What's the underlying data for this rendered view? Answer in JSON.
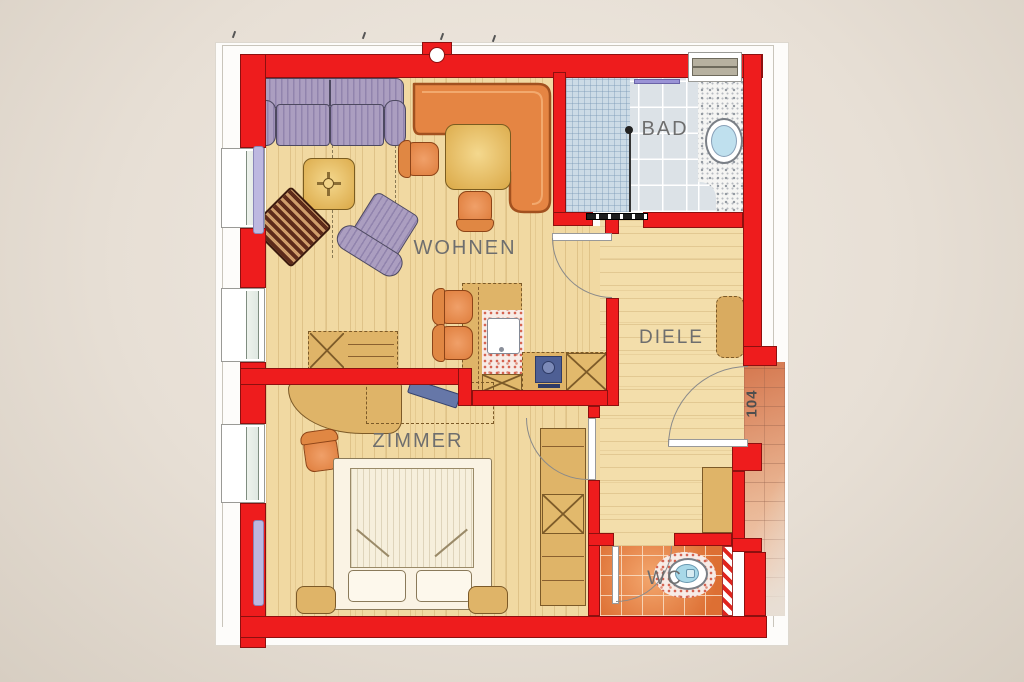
{
  "rooms": {
    "living": {
      "label": "WOHNEN"
    },
    "bedroom": {
      "label": "ZIMMER"
    },
    "hallway": {
      "label": "DIELE"
    },
    "bathroom": {
      "label": "BAD"
    },
    "toilet": {
      "label": "WC"
    },
    "apartment_number": {
      "label": "104"
    }
  },
  "colors": {
    "wall_red": "#ee1c1d",
    "wood_floor": "#f1d9a2",
    "bath_tile": "#dce2e7",
    "wc_tile": "#dd6f33",
    "corridor_brick": "#d5774e",
    "furniture_tan": "#dfb468",
    "furniture_orange": "#e08040",
    "upholstery_purple": "#ab9ec0",
    "label_gray": "#6e6e6e"
  }
}
